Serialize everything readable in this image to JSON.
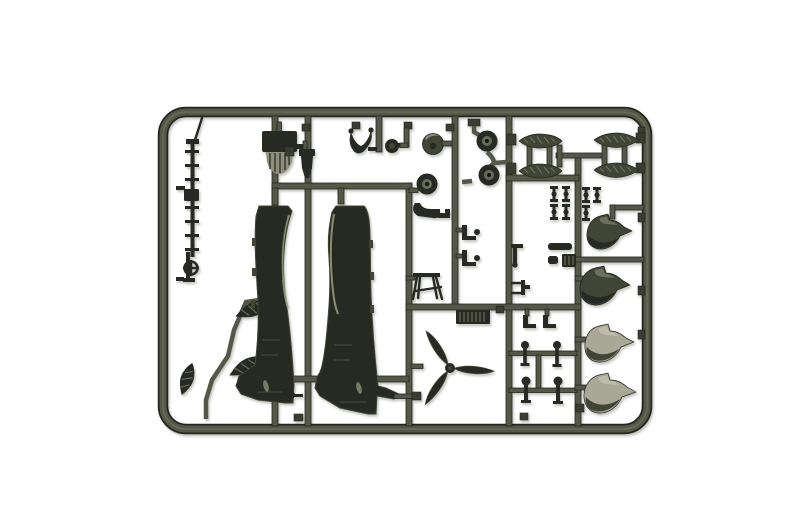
{
  "scene": {
    "type": "product-photo",
    "subject": "Injection-molded plastic model kit sprue with olive drab aircraft parts on a white background",
    "plastic_color_name": "olive drab green",
    "background_name": "white studio backdrop",
    "text_visible": "none"
  },
  "colors": {
    "bg": "#ffffff",
    "vignette": "#e8e8e5",
    "runner": "#545948",
    "runner_dark": "#3a3e30",
    "runner_edge": "#23261c",
    "part_dark": "#262a20",
    "part_mid": "#3f4434",
    "part_light": "#8e8e7b",
    "part_lighter": "#a9a795",
    "highlight": "#9ba081",
    "hatch": "#6f725a",
    "hub": "#686c58",
    "hole": "#15170f"
  },
  "parts": [
    {
      "name": "fuselage-half",
      "count": 2
    },
    {
      "name": "three-blade-propeller",
      "count": 1
    },
    {
      "name": "drop-tank-half",
      "count": 4
    },
    {
      "name": "wheel-half",
      "count": 3
    },
    {
      "name": "spinner-dome",
      "count": 1
    },
    {
      "name": "wheel-spat-fairing-half",
      "count": 4
    },
    {
      "name": "float-bomb-half",
      "count": 3
    },
    {
      "name": "boarding-ladder",
      "count": 1
    },
    {
      "name": "gunsight-ring",
      "count": 1
    },
    {
      "name": "oil-cooler-grille",
      "count": 1
    },
    {
      "name": "engine-accessory",
      "count": 1
    },
    {
      "name": "control-yoke",
      "count": 1
    },
    {
      "name": "landing-gear-strut",
      "count": 4
    },
    {
      "name": "axle-small-part",
      "count": 7
    },
    {
      "name": "maintenance-trestle",
      "count": 1
    },
    {
      "name": "ribbed-access-panel",
      "count": 1
    },
    {
      "name": "small-bracket",
      "count": 8
    }
  ]
}
